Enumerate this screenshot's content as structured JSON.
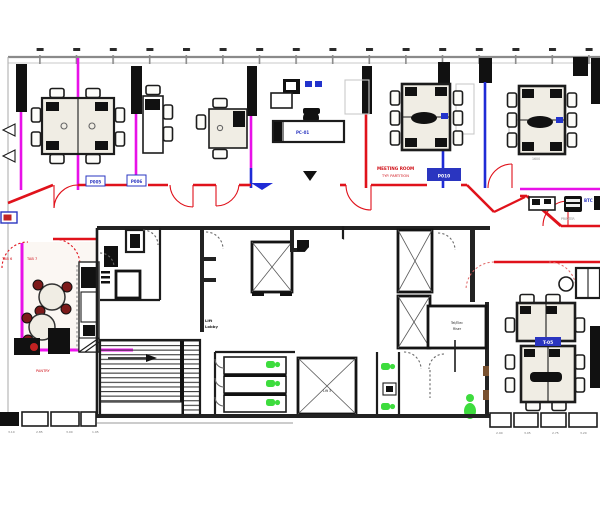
{
  "page": {
    "kind": "architectural office floor plan"
  },
  "colors": {
    "wall_red": "#e0121b",
    "partition_magenta": "#e811e8",
    "glazing_blue": "#1f2bd6",
    "fixture_green": "#3ddc3d",
    "chair_maroon": "#7c1a1a",
    "ink_black": "#1c1c1c",
    "facade_gray": "#8a8a8a",
    "table_fill": "#f0ede4",
    "tag_navy": "#2a35c0",
    "ghost_gray": "#c9c9c9"
  },
  "labels": {
    "door_tag_1": "P005",
    "door_tag_2": "P006",
    "door_tag_3": "P010",
    "partition_note_1": "MEETING ROOM",
    "partition_note_2": "TYP. PARTITION",
    "reception_tag": "PC-01",
    "breakroom_tag_1": "TAB 6",
    "breakroom_tag_2": "TAB 7",
    "pantry": "PANTRY",
    "lift_lobby_line1": "Lift",
    "lift_lobby_line2": "Lobby",
    "riser_line1": "Tel/Elec",
    "riser_line2": "Riser",
    "lift_car": "Lift 3",
    "btc": "BTC",
    "printer": "PRINTER",
    "table_tag": "T-05",
    "table_dim": "1600"
  },
  "dimensions": {
    "left": [
      "3.10",
      "2.85",
      "3.00",
      "1.95"
    ],
    "right": [
      "2.90",
      "3.05",
      "2.75",
      "3.20"
    ]
  }
}
